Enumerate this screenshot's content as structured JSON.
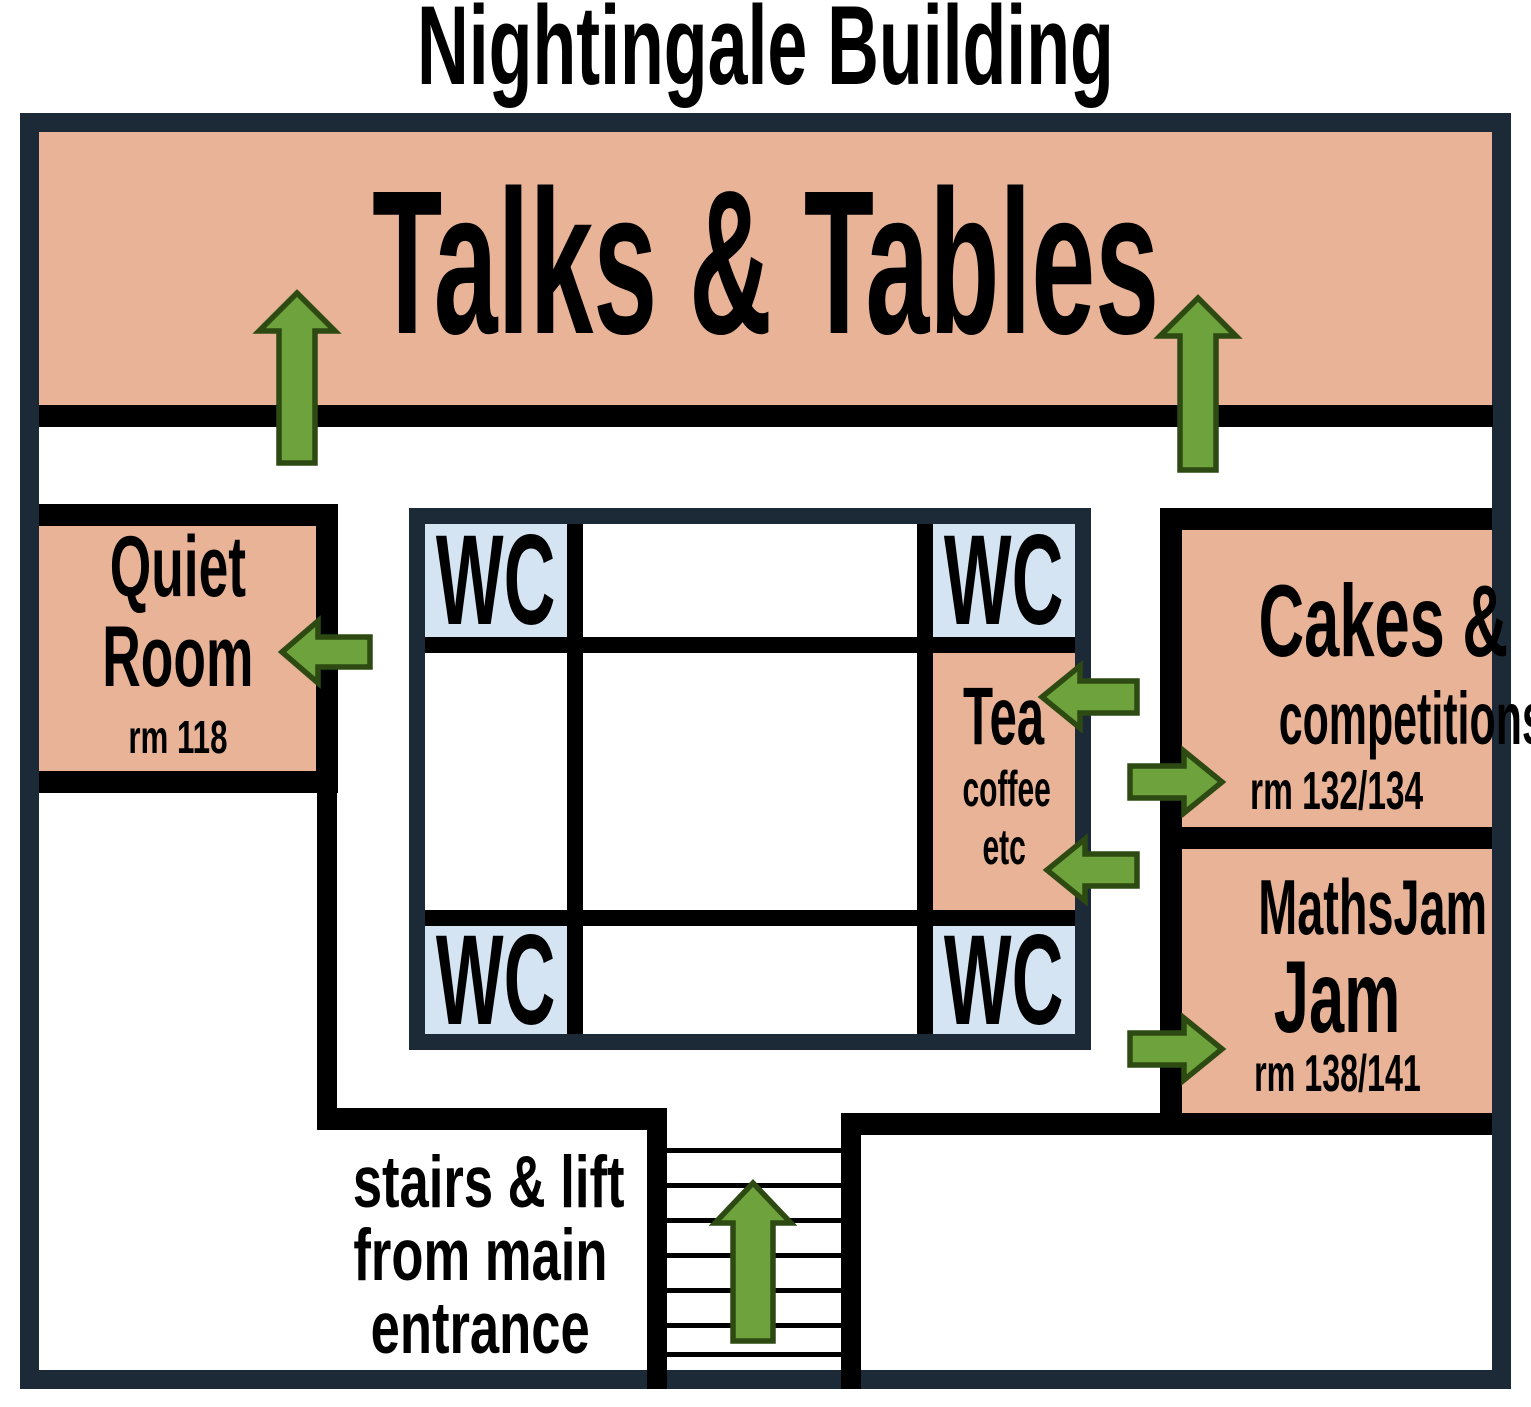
{
  "title": "Nightingale Building",
  "colors": {
    "wall_navy": "#1c2a37",
    "room_salmon": "#e8b397",
    "wc_blue": "#d4e4f2",
    "arrow_green": "#6da23d",
    "arrow_outline": "#2d4a12",
    "interior_line": "#000000"
  },
  "rooms": {
    "talks": {
      "label": "Talks & Tables"
    },
    "quiet": {
      "name_line1": "Quiet",
      "name_line2": "Room",
      "room_number": "rm 118"
    },
    "wc": {
      "label": "WC"
    },
    "tea": {
      "name": "Tea",
      "sub_line1": "coffee",
      "sub_line2": "etc"
    },
    "cakes": {
      "name_line1": "Cakes &",
      "name_line2": "competitions",
      "room_number": "rm 132/134"
    },
    "mathsjam": {
      "name_line1": "MathsJam",
      "name_line2": "Jam",
      "room_number": "rm 138/141"
    },
    "stairs": {
      "label_line1": "stairs & lift",
      "label_line2": "from main",
      "label_line3": "entrance"
    }
  },
  "arrows": [
    {
      "name": "up-arrow-into-talks-left",
      "direction": "up"
    },
    {
      "name": "up-arrow-into-talks-right",
      "direction": "up"
    },
    {
      "name": "left-arrow-into-quiet-room",
      "direction": "left"
    },
    {
      "name": "left-arrow-into-tea-upper",
      "direction": "left"
    },
    {
      "name": "right-arrow-into-cakes",
      "direction": "right"
    },
    {
      "name": "left-arrow-into-tea-lower",
      "direction": "left"
    },
    {
      "name": "right-arrow-into-mathsjam",
      "direction": "right"
    },
    {
      "name": "up-arrow-stairs",
      "direction": "up"
    }
  ]
}
